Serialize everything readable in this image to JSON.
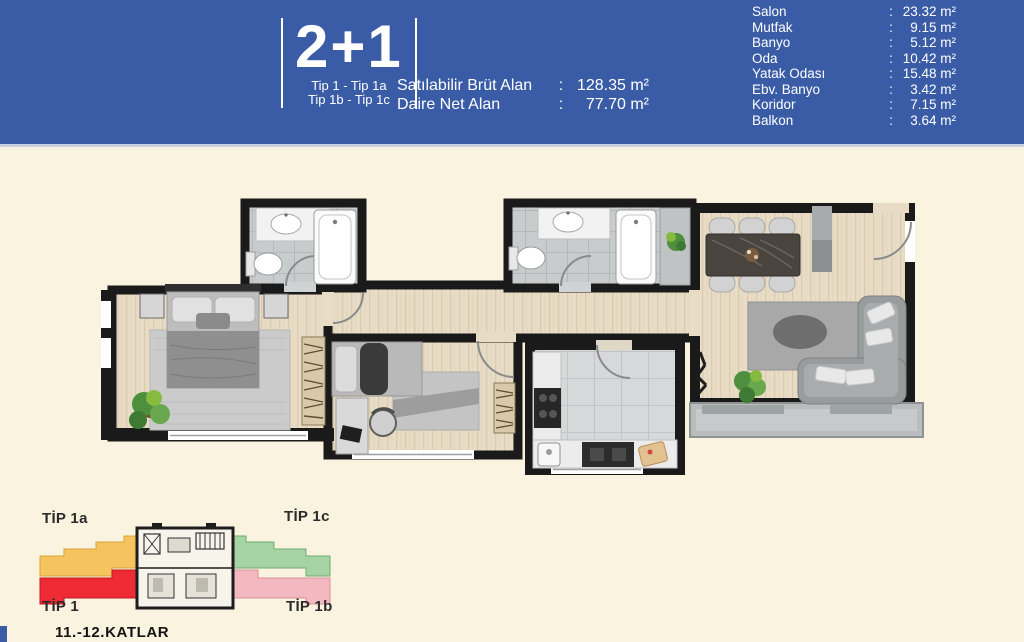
{
  "header": {
    "unit_type": "2+1",
    "type_lines": [
      "Tip 1 - Tip 1a",
      "Tip 1b - Tip 1c"
    ],
    "colon": ":",
    "areas": [
      {
        "label": "Satılabilir Brüt Alan",
        "value": "128.35 m²"
      },
      {
        "label": "Daire Net Alan",
        "value": "77.70 m²"
      }
    ],
    "rooms": [
      {
        "label": "Salon",
        "value": "23.32 m²"
      },
      {
        "label": "Mutfak",
        "value": "9.15 m²"
      },
      {
        "label": "Banyo",
        "value": "5.12 m²"
      },
      {
        "label": "Oda",
        "value": "10.42 m²"
      },
      {
        "label": "Yatak Odası",
        "value": "15.48 m²"
      },
      {
        "label": "Ebv. Banyo",
        "value": "3.42 m²"
      },
      {
        "label": "Koridor",
        "value": "7.15 m²"
      },
      {
        "label": "Balkon",
        "value": "3.64 m²"
      }
    ]
  },
  "key_plan": {
    "labels": {
      "top_left": "TİP 1a",
      "top_right": "TİP 1c",
      "bottom_left": "TİP 1",
      "bottom_right": "TİP 1b"
    },
    "floors": "11.-12.KATLAR",
    "colors": {
      "tip1a": "#f5c45e",
      "tip1": "#ee2a35",
      "tip1c": "#a6d3a4",
      "tip1b": "#f3b8c0"
    }
  },
  "colors": {
    "header_blue": "#3a5ca6",
    "background_cream": "#faf3df",
    "wall_black": "#1a1a1a",
    "wood_floor": "#e8dcc6",
    "tile_gray": "#c8cccd"
  }
}
